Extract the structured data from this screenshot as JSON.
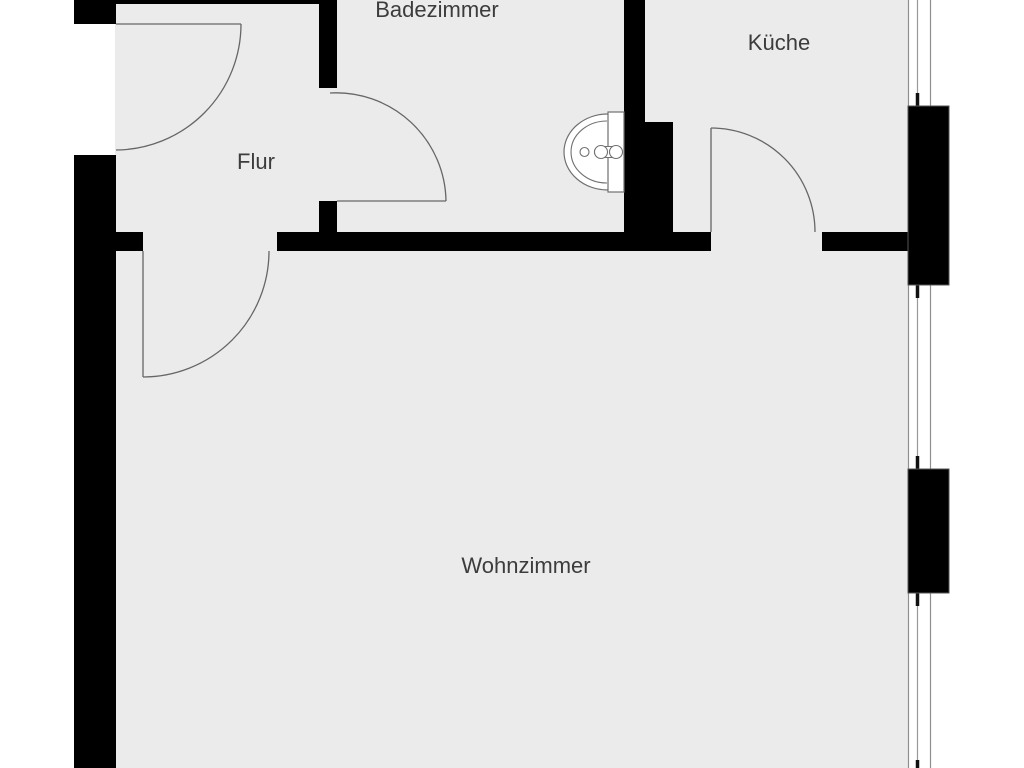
{
  "title": "Floor plan (German apartment)",
  "canvas": {
    "width": 1024,
    "height": 768
  },
  "palette": {
    "background": "#ffffff",
    "floor": "#ebebeb",
    "wall": "#000000",
    "door_line": "#666666",
    "window_line": "#8f8f8f",
    "mullion_line": "#9a9a9a",
    "mullion_tick": "#111111",
    "pier_stroke": "#555555",
    "text": "#3c3c3c",
    "fixture_stroke": "#707070",
    "fixture_fill": "#ffffff"
  },
  "floor": {
    "x": 115,
    "y": 0,
    "w": 793,
    "h": 768
  },
  "rooms": [
    {
      "id": "badezimmer",
      "label": "Badezimmer",
      "cx": 437,
      "cy": 10
    },
    {
      "id": "kueche",
      "label": "Küche",
      "cx": 779,
      "cy": 43
    },
    {
      "id": "flur",
      "label": "Flur",
      "cx": 256,
      "cy": 162
    },
    {
      "id": "wohnzimmer",
      "label": "Wohnzimmer",
      "cx": 526,
      "cy": 566
    }
  ],
  "walls": [
    {
      "name": "top-outer-wall",
      "r": [
        116,
        0,
        203,
        4
      ]
    },
    {
      "name": "entry-jamb-block",
      "r": [
        74,
        0,
        42,
        24
      ]
    },
    {
      "name": "left-outer-wall",
      "r": [
        74,
        155,
        42,
        613
      ]
    },
    {
      "name": "hall-bathroom-wall-upper",
      "r": [
        319,
        0,
        18,
        88
      ]
    },
    {
      "name": "hall-bathroom-wall-lower",
      "r": [
        319,
        201,
        18,
        31
      ]
    },
    {
      "name": "hall-living-wall-stub",
      "r": [
        116,
        232,
        27,
        19
      ]
    },
    {
      "name": "center-dividing-wall",
      "r": [
        277,
        232,
        434,
        19
      ]
    },
    {
      "name": "kitchen-living-wall-right",
      "r": [
        822,
        232,
        86,
        19
      ]
    },
    {
      "name": "bathroom-kitchen-wall",
      "r": [
        624,
        0,
        21,
        232
      ]
    },
    {
      "name": "bathroom-kitchen-duct-block",
      "r": [
        645,
        122,
        28,
        110
      ]
    }
  ],
  "window_wall": {
    "x_lines": [
      908.5,
      930.5
    ],
    "mullion_x": 917.5,
    "y1": 0,
    "y2": 768,
    "ticks": [
      [
        93,
        106
      ],
      [
        285,
        298
      ],
      [
        456,
        469
      ],
      [
        593,
        606
      ],
      [
        760,
        768
      ]
    ],
    "piers": [
      {
        "name": "window-pier-upper",
        "r": [
          908,
          106,
          41,
          179
        ]
      },
      {
        "name": "window-pier-lower",
        "r": [
          908,
          469,
          41,
          124
        ]
      }
    ]
  },
  "doors": [
    {
      "name": "entry-door",
      "leaf": [
        116,
        24,
        241,
        24
      ],
      "arc": "M 241 24 A 126 126 0 0 1 116 150"
    },
    {
      "name": "bathroom-door",
      "leaf": [
        337,
        201,
        446,
        201
      ],
      "arc": "M 446 201 A 110 110 0 0 0 330 93"
    },
    {
      "name": "livingroom-door",
      "leaf": [
        143,
        251,
        143,
        377
      ],
      "arc": "M 143 377 A 126 126 0 0 0 269 251"
    },
    {
      "name": "kitchen-door",
      "leaf": [
        711,
        128,
        711,
        232
      ],
      "arc": "M 711 128 A 104 104 0 0 1 815 232"
    }
  ],
  "sink": {
    "basin_rect": [
      608,
      112,
      16,
      80
    ],
    "bowl_outer": "M 608 114 A 44 38 0 0 0 608 190",
    "bowl_inner": "M 607 121 A 36 31 0 0 0 607 183",
    "knob_circle": [
      584.5,
      152,
      4.5
    ],
    "handle_rect": [
      594.5,
      146.5,
      27,
      11,
      5.5
    ],
    "handle_circles": [
      [
        601,
        152,
        6.5
      ],
      [
        616,
        152,
        6.5
      ]
    ]
  }
}
